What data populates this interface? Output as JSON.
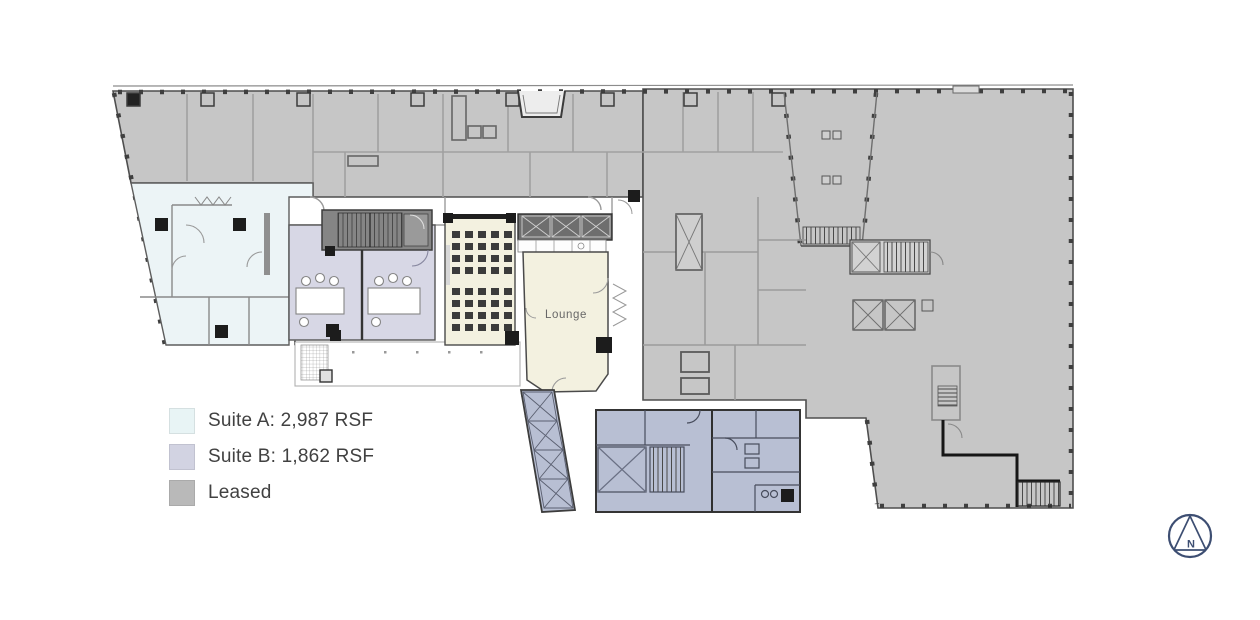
{
  "legend": {
    "items": [
      {
        "id": "suite-a",
        "label": "Suite A: 2,987 RSF",
        "color": "#e8f4f5"
      },
      {
        "id": "suite-b",
        "label": "Suite B: 1,862 RSF",
        "color": "#d2d3e2"
      },
      {
        "id": "leased",
        "label": "Leased",
        "color": "#b9b9b9"
      }
    ],
    "text_color": "#414141"
  },
  "plan": {
    "lounge_label": "Lounge",
    "colors": {
      "leased_fill": "#c6c6c6",
      "suite_a_fill": "#ecf4f6",
      "suite_b_fill": "#d7d7e5",
      "amenity_cream": "#f3f1e0",
      "core_blue": "#b8bfd3",
      "stair_dark": "#858585",
      "lobby_dark": "#6e6e6e",
      "terrace_white": "#ffffff",
      "wall_dark": "#3c3c3c",
      "wall_light": "#9b9b9b"
    }
  },
  "north_arrow": {
    "label": "N",
    "color": "#3d4e72"
  }
}
